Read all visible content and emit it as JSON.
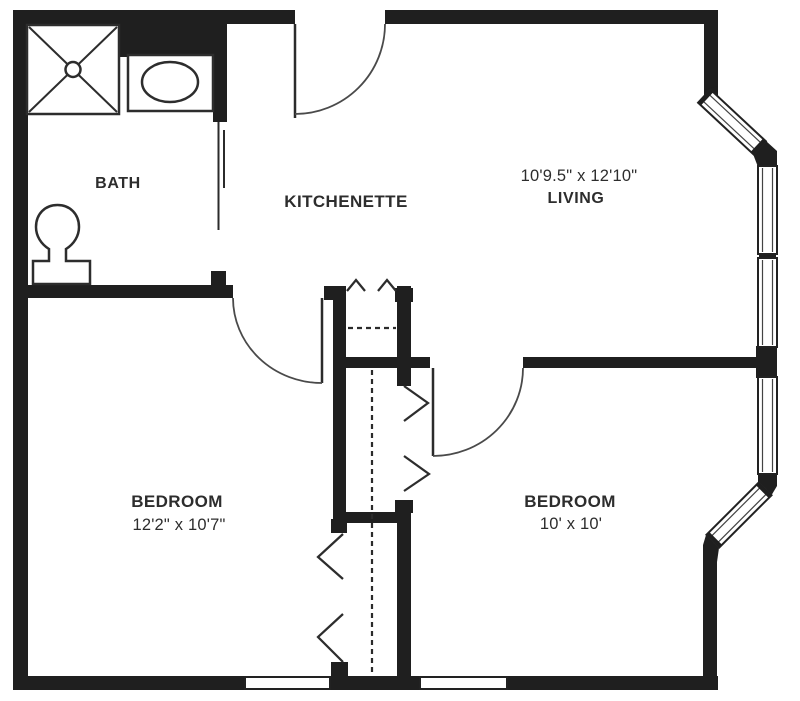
{
  "plan": {
    "title": "one-bedroom-unit-floor-plan",
    "background_color": "#ffffff",
    "wall_color": "#1f1f1f",
    "text_color": "#2d2d2d",
    "rooms": {
      "bath": {
        "label": "BATH"
      },
      "kitchenette": {
        "label": "KITCHENETTE"
      },
      "living": {
        "label": "LIVING",
        "dimensions": "10'9.5\" x 12'10\""
      },
      "bedroom_left": {
        "label": "BEDROOM",
        "dimensions": "12'2\" x 10'7\""
      },
      "bedroom_right": {
        "label": "BEDROOM",
        "dimensions": "10' x 10'"
      }
    },
    "fixtures": {
      "shower": "shower-icon",
      "sink": "sink-icon",
      "toilet": "toilet-icon"
    }
  }
}
